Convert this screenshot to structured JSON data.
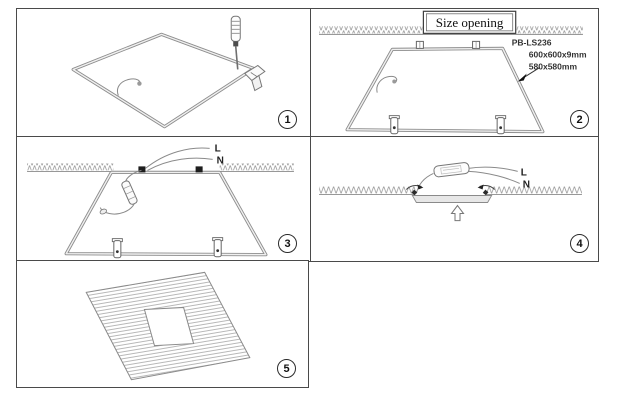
{
  "diagram": {
    "steps": [
      {
        "number": "1"
      },
      {
        "number": "2"
      },
      {
        "number": "3"
      },
      {
        "number": "4"
      },
      {
        "number": "5"
      }
    ]
  },
  "step2": {
    "size_opening_label": "Size opening",
    "model": "PB-LS236",
    "panel_size": "600x600x9mm",
    "cutout_size": "580x580mm"
  },
  "step3": {
    "live_label": "L",
    "neutral_label": "N"
  },
  "step4": {
    "live_label": "L",
    "neutral_label": "N"
  },
  "colors": {
    "line": "#7a7a7a",
    "frame": "#8d8d8d",
    "hatch": "#9a9a9a"
  }
}
